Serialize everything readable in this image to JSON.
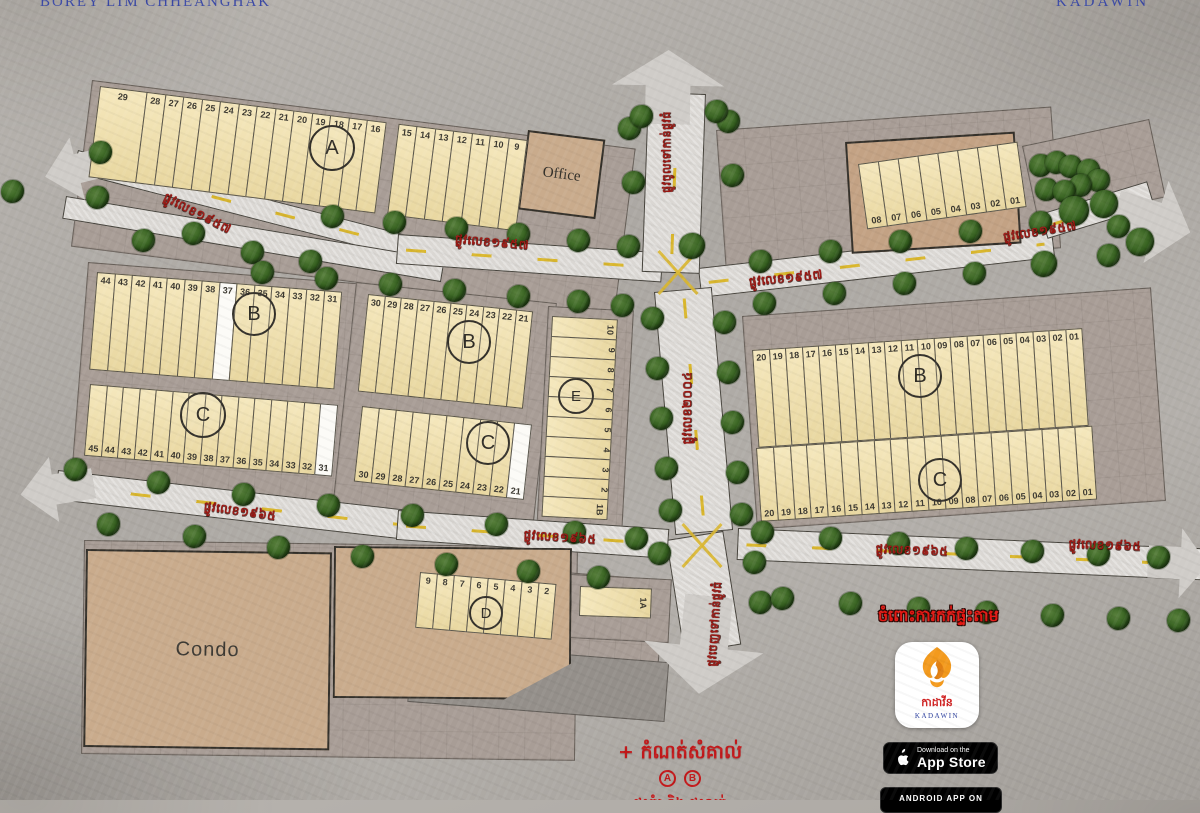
{
  "header": {
    "left": "BOREY LIM CHHEANGHAK",
    "right": "KADAWIN"
  },
  "parcels": {
    "office": "Office",
    "condo": "Condo",
    "villa": "Villa"
  },
  "notes": {
    "booking": "ចំពោះការកក់ផ្ទះតាម"
  },
  "legend": {
    "title": "+ កំណត់សំគាល់",
    "badge_a": "A",
    "badge_b": "B",
    "more": "ផ្ទះគំរូ និង ផ្ទះលក់"
  },
  "store": {
    "khmer": "កាដាវីន",
    "latin": "KADAWIN",
    "ios_line1": "Download on the",
    "ios_line2": "App Store",
    "android_line1": "ANDROID APP ON"
  },
  "colors": {
    "plot": "#f2e0a7",
    "plot_sold": "#fcfbf7",
    "brand_blue": "#3a48a5",
    "street_red": "#9c1712",
    "note_red": "#e51712",
    "tree_green": "#35611f"
  },
  "map": {
    "panels": [
      {
        "x": 84,
        "y": 540,
        "w": 494,
        "h": 214,
        "rot": 0.8
      },
      {
        "x": 92,
        "y": 80,
        "w": 548,
        "h": 168,
        "rot": 7.2
      },
      {
        "x": 716,
        "y": 130,
        "w": 336,
        "h": 142,
        "rot": -4
      },
      {
        "x": 1022,
        "y": 146,
        "w": 130,
        "h": 80,
        "rot": -12
      },
      {
        "x": 88,
        "y": 262,
        "w": 280,
        "h": 224,
        "rot": 4.5
      },
      {
        "x": 356,
        "y": 282,
        "w": 202,
        "h": 230,
        "rot": 6
      },
      {
        "x": 548,
        "y": 306,
        "w": 86,
        "h": 232,
        "rot": 3
      },
      {
        "x": 742,
        "y": 316,
        "w": 410,
        "h": 214,
        "rot": -4
      },
      {
        "x": 412,
        "y": 560,
        "w": 254,
        "h": 94,
        "rot": 4.5
      },
      {
        "x": 570,
        "y": 574,
        "w": 102,
        "h": 64,
        "rot": 3
      },
      {
        "x": 412,
        "y": 642,
        "w": 258,
        "h": 60,
        "rot": 4.5,
        "bg": "#948f8a"
      }
    ],
    "roads": [
      {
        "x": 78,
        "y": 150,
        "w": 372,
        "h": 23,
        "rot": 14.5,
        "dash": true
      },
      {
        "x": 66,
        "y": 196,
        "w": 384,
        "h": 23,
        "rot": 9.5,
        "dash": false
      },
      {
        "x": 398,
        "y": 234,
        "w": 266,
        "h": 30,
        "rot": 4,
        "dash": true
      },
      {
        "x": 698,
        "y": 268,
        "w": 356,
        "h": 30,
        "rot": -6.5,
        "dash": true
      },
      {
        "x": 1040,
        "y": 214,
        "w": 112,
        "h": 26,
        "rot": -17,
        "dash": true
      },
      {
        "x": 648,
        "y": 92,
        "w": 58,
        "h": 180,
        "rot": 2,
        "vertical": true,
        "dash": true
      },
      {
        "x": 654,
        "y": 292,
        "w": 58,
        "h": 244,
        "rot": -5,
        "vertical": true,
        "dash": true
      },
      {
        "x": 666,
        "y": 540,
        "w": 58,
        "h": 115,
        "rot": -9,
        "vertical": true,
        "dash": false
      },
      {
        "x": 58,
        "y": 470,
        "w": 352,
        "h": 30,
        "rot": 6.5,
        "dash": true
      },
      {
        "x": 398,
        "y": 510,
        "w": 272,
        "h": 30,
        "rot": 4,
        "dash": true
      },
      {
        "x": 738,
        "y": 528,
        "w": 468,
        "h": 32,
        "rot": 2.5,
        "dash": true
      }
    ],
    "arrows": [
      {
        "dir": "left",
        "x": 44,
        "y": 136,
        "w": 72,
        "h": 64,
        "rot": -14
      },
      {
        "dir": "left",
        "x": 20,
        "y": 456,
        "w": 74,
        "h": 66,
        "rot": -9
      },
      {
        "dir": "up",
        "x": 612,
        "y": 50,
        "w": 112,
        "h": 74,
        "rot": 1
      },
      {
        "dir": "right",
        "x": 1114,
        "y": 178,
        "w": 78,
        "h": 86,
        "rot": 17
      },
      {
        "dir": "down",
        "x": 644,
        "y": 596,
        "w": 120,
        "h": 98,
        "rot": 6
      },
      {
        "dir": "right",
        "x": 1148,
        "y": 528,
        "w": 60,
        "h": 70,
        "rot": 3
      }
    ],
    "intersections": [
      {
        "x": 678,
        "y": 272
      },
      {
        "x": 702,
        "y": 545
      }
    ],
    "trees": [
      [
        12,
        191
      ],
      [
        100,
        152
      ],
      [
        97,
        197
      ],
      [
        143,
        240
      ],
      [
        193,
        233
      ],
      [
        252,
        252
      ],
      [
        310,
        261
      ],
      [
        332,
        216
      ],
      [
        394,
        222
      ],
      [
        456,
        228
      ],
      [
        518,
        234
      ],
      [
        578,
        240
      ],
      [
        628,
        246
      ],
      [
        262,
        272
      ],
      [
        326,
        278
      ],
      [
        390,
        284
      ],
      [
        454,
        290
      ],
      [
        518,
        296
      ],
      [
        578,
        301
      ],
      [
        622,
        305
      ],
      [
        692,
        246,
        26
      ],
      [
        760,
        261
      ],
      [
        830,
        251
      ],
      [
        900,
        241
      ],
      [
        970,
        231
      ],
      [
        1040,
        222
      ],
      [
        764,
        303
      ],
      [
        834,
        293
      ],
      [
        904,
        283
      ],
      [
        974,
        273
      ],
      [
        1044,
        264,
        26
      ],
      [
        1108,
        255
      ],
      [
        1040,
        165
      ],
      [
        1056,
        162
      ],
      [
        1070,
        166
      ],
      [
        1088,
        170
      ],
      [
        1098,
        180
      ],
      [
        1080,
        185
      ],
      [
        1046,
        189
      ],
      [
        1064,
        191
      ],
      [
        1074,
        211,
        30
      ],
      [
        1104,
        204,
        28
      ],
      [
        1118,
        226
      ],
      [
        1140,
        242,
        28
      ],
      [
        629,
        128
      ],
      [
        633,
        182
      ],
      [
        728,
        121
      ],
      [
        732,
        175
      ],
      [
        641,
        116
      ],
      [
        716,
        111
      ],
      [
        652,
        318
      ],
      [
        657,
        368
      ],
      [
        661,
        418
      ],
      [
        666,
        468
      ],
      [
        670,
        510
      ],
      [
        724,
        322
      ],
      [
        728,
        372
      ],
      [
        732,
        422
      ],
      [
        737,
        472
      ],
      [
        741,
        514
      ],
      [
        659,
        553
      ],
      [
        754,
        562
      ],
      [
        760,
        602
      ],
      [
        75,
        469
      ],
      [
        158,
        482
      ],
      [
        243,
        494
      ],
      [
        328,
        505
      ],
      [
        412,
        515
      ],
      [
        496,
        524
      ],
      [
        574,
        532
      ],
      [
        636,
        538
      ],
      [
        108,
        524
      ],
      [
        194,
        536
      ],
      [
        278,
        547
      ],
      [
        362,
        556
      ],
      [
        446,
        564
      ],
      [
        528,
        571
      ],
      [
        598,
        577
      ],
      [
        762,
        532
      ],
      [
        830,
        538
      ],
      [
        898,
        543
      ],
      [
        966,
        548
      ],
      [
        1032,
        551
      ],
      [
        1098,
        554
      ],
      [
        1158,
        557
      ],
      [
        782,
        598
      ],
      [
        850,
        603
      ],
      [
        918,
        608
      ],
      [
        986,
        612
      ],
      [
        1052,
        615
      ],
      [
        1118,
        618
      ],
      [
        1178,
        620
      ]
    ],
    "blocks": [
      {
        "name": "a",
        "x": 100,
        "y": 86,
        "rot": 7.2,
        "h": 92,
        "numPos": "top",
        "cellW": 19.5,
        "cells": [
          {
            "n": "29",
            "w": 48
          },
          {
            "n": "28"
          },
          {
            "n": "27"
          },
          {
            "n": "26"
          },
          {
            "n": "25"
          },
          {
            "n": "24"
          },
          {
            "n": "23"
          },
          {
            "n": "22"
          },
          {
            "n": "21"
          },
          {
            "n": "20"
          },
          {
            "n": "19"
          },
          {
            "n": "18"
          },
          {
            "n": "17"
          },
          {
            "n": "16"
          },
          {
            "n": "",
            "w": 14,
            "sp": 1
          },
          {
            "n": "15"
          },
          {
            "n": "14"
          },
          {
            "n": "13"
          },
          {
            "n": "12"
          },
          {
            "n": "11"
          },
          {
            "n": "10"
          },
          {
            "n": "9"
          }
        ]
      },
      {
        "name": "top-right",
        "x": 858,
        "y": 164,
        "rot": -8,
        "h": 66,
        "numPos": "bot",
        "cellW": 21,
        "cells": [
          {
            "n": "08"
          },
          {
            "n": "07"
          },
          {
            "n": "06"
          },
          {
            "n": "05"
          },
          {
            "n": "04"
          },
          {
            "n": "03"
          },
          {
            "n": "02"
          },
          {
            "n": "01"
          }
        ]
      },
      {
        "name": "b-left",
        "x": 97,
        "y": 272,
        "rot": 4.6,
        "h": 98,
        "numPos": "top",
        "cellW": 18.5,
        "cells": [
          {
            "n": "44"
          },
          {
            "n": "43"
          },
          {
            "n": "42"
          },
          {
            "n": "41"
          },
          {
            "n": "40"
          },
          {
            "n": "39"
          },
          {
            "n": "38"
          },
          {
            "n": "37",
            "wh": 1
          },
          {
            "n": "36"
          },
          {
            "n": "35"
          },
          {
            "n": "34"
          },
          {
            "n": "33"
          },
          {
            "n": "32"
          },
          {
            "n": "31"
          }
        ]
      },
      {
        "name": "c-left",
        "x": 90,
        "y": 384,
        "rot": 4.8,
        "h": 72,
        "numPos": "bot",
        "cellW": 17.5,
        "cells": [
          {
            "n": "45"
          },
          {
            "n": "44"
          },
          {
            "n": "43"
          },
          {
            "n": "42"
          },
          {
            "n": "41"
          },
          {
            "n": "40"
          },
          {
            "n": "39"
          },
          {
            "n": "38"
          },
          {
            "n": "37"
          },
          {
            "n": "36"
          },
          {
            "n": "35"
          },
          {
            "n": "34"
          },
          {
            "n": "33"
          },
          {
            "n": "32"
          },
          {
            "n": "31",
            "wh": 1
          }
        ]
      },
      {
        "name": "b-mid",
        "x": 368,
        "y": 294,
        "rot": 6,
        "h": 98,
        "numPos": "top",
        "cellW": 17.5,
        "cells": [
          {
            "n": "30"
          },
          {
            "n": "29"
          },
          {
            "n": "28"
          },
          {
            "n": "27"
          },
          {
            "n": "26"
          },
          {
            "n": "25"
          },
          {
            "n": "24"
          },
          {
            "n": "23"
          },
          {
            "n": "22"
          },
          {
            "n": "21"
          }
        ]
      },
      {
        "name": "c-mid",
        "x": 362,
        "y": 406,
        "rot": 6.2,
        "h": 76,
        "numPos": "bot",
        "cellW": 18,
        "cells": [
          {
            "n": "30"
          },
          {
            "n": "29"
          },
          {
            "n": "28"
          },
          {
            "n": "27"
          },
          {
            "n": "26"
          },
          {
            "n": "25"
          },
          {
            "n": "24"
          },
          {
            "n": "23"
          },
          {
            "n": "22"
          },
          {
            "n": "21",
            "wh": 1
          }
        ]
      },
      {
        "name": "e",
        "x": 552,
        "y": 316,
        "rot": 3,
        "vertical": true,
        "w": 66,
        "cellH": 21,
        "cells": [
          {
            "n": "10"
          },
          {
            "n": "9"
          },
          {
            "n": "8"
          },
          {
            "n": "7"
          },
          {
            "n": "6"
          },
          {
            "n": "5"
          },
          {
            "n": "4"
          },
          {
            "n": "3"
          },
          {
            "n": "2"
          },
          {
            "n": "1B"
          }
        ]
      },
      {
        "name": "b-right",
        "x": 752,
        "y": 350,
        "rot": -3.8,
        "h": 98,
        "numPos": "top",
        "cellW": 17.5,
        "cells": [
          {
            "n": "20"
          },
          {
            "n": "19"
          },
          {
            "n": "18"
          },
          {
            "n": "17"
          },
          {
            "n": "16"
          },
          {
            "n": "15"
          },
          {
            "n": "14"
          },
          {
            "n": "13"
          },
          {
            "n": "12"
          },
          {
            "n": "11"
          },
          {
            "n": "10"
          },
          {
            "n": "09"
          },
          {
            "n": "08"
          },
          {
            "n": "07"
          },
          {
            "n": "06"
          },
          {
            "n": "05"
          },
          {
            "n": "04"
          },
          {
            "n": "03"
          },
          {
            "n": "02"
          },
          {
            "n": "01"
          }
        ]
      },
      {
        "name": "c-right",
        "x": 756,
        "y": 448,
        "rot": -3.8,
        "h": 74,
        "numPos": "bot",
        "cellW": 17.8,
        "cells": [
          {
            "n": "20"
          },
          {
            "n": "19"
          },
          {
            "n": "18"
          },
          {
            "n": "17"
          },
          {
            "n": "16"
          },
          {
            "n": "15"
          },
          {
            "n": "14"
          },
          {
            "n": "13"
          },
          {
            "n": "12"
          },
          {
            "n": "11"
          },
          {
            "n": "10"
          },
          {
            "n": "09"
          },
          {
            "n": "08"
          },
          {
            "n": "07"
          },
          {
            "n": "06"
          },
          {
            "n": "05"
          },
          {
            "n": "04"
          },
          {
            "n": "03"
          },
          {
            "n": "02"
          },
          {
            "n": "01"
          }
        ]
      },
      {
        "name": "d",
        "x": 420,
        "y": 572,
        "rot": 5,
        "h": 56,
        "numPos": "top",
        "cellW": 18,
        "cells": [
          {
            "n": "9"
          },
          {
            "n": "8"
          },
          {
            "n": "7"
          },
          {
            "n": "6"
          },
          {
            "n": "5"
          },
          {
            "n": "4"
          },
          {
            "n": "3"
          },
          {
            "n": "2"
          }
        ]
      },
      {
        "name": "plot-1a",
        "x": 580,
        "y": 586,
        "rot": 2,
        "vertical": true,
        "w": 72,
        "cellH": 30,
        "cells": [
          {
            "n": "1A"
          }
        ]
      }
    ],
    "circles": [
      {
        "l": "A",
        "x": 330,
        "y": 146,
        "d": 42
      },
      {
        "l": "B",
        "x": 252,
        "y": 312,
        "d": 40
      },
      {
        "l": "B",
        "x": 467,
        "y": 340,
        "d": 40
      },
      {
        "l": "E",
        "x": 574,
        "y": 394,
        "d": 32,
        "fs": 15
      },
      {
        "l": "B",
        "x": 918,
        "y": 374,
        "d": 40
      },
      {
        "l": "C",
        "x": 201,
        "y": 413,
        "d": 42
      },
      {
        "l": "C",
        "x": 486,
        "y": 441,
        "d": 40
      },
      {
        "l": "C",
        "x": 938,
        "y": 478,
        "d": 40
      },
      {
        "l": "D",
        "x": 484,
        "y": 611,
        "d": 30,
        "fs": 15
      }
    ],
    "streets": [
      {
        "t": "ផ្លូវលេខ១៩៥៧",
        "x": 197,
        "y": 214,
        "r": 27
      },
      {
        "t": "ផ្លូវលេខ១៩៥៧",
        "x": 492,
        "y": 243,
        "r": 5
      },
      {
        "t": "ផ្លូវលេខ១៩៥៧",
        "x": 786,
        "y": 279,
        "r": -6
      },
      {
        "t": "ផ្លូវលេខ១៩៥៧",
        "x": 1040,
        "y": 232,
        "r": -9
      },
      {
        "t": "ផ្លូវលេខ១៩៦៥",
        "x": 240,
        "y": 512,
        "r": 8
      },
      {
        "t": "ផ្លូវលេខ១៩៦៥",
        "x": 560,
        "y": 538,
        "r": 4
      },
      {
        "t": "ផ្លូវលេខ១៩៦៥",
        "x": 912,
        "y": 551,
        "r": 2
      },
      {
        "t": "ផ្លូវលេខ១៩៦៥",
        "x": 1105,
        "y": 546,
        "r": 2
      },
      {
        "t": "ផ្លូវចូលទៅកាន់ផ្លូវធំ",
        "x": 668,
        "y": 152,
        "r": -90,
        "fs": 11
      },
      {
        "t": "ផ្លូវលេខ២០០៤",
        "x": 688,
        "y": 408,
        "r": -90
      },
      {
        "t": "ផ្លូវចេញទៅកាន់ផ្លូវធំ",
        "x": 716,
        "y": 624,
        "r": -86,
        "fs": 11
      }
    ]
  }
}
